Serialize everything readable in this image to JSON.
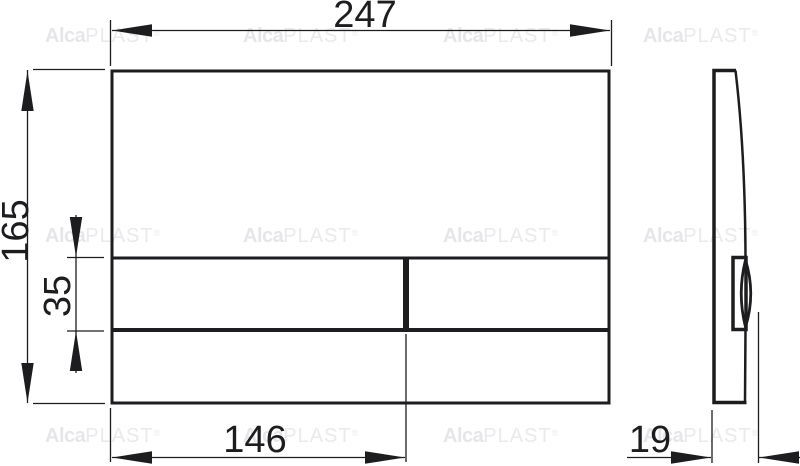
{
  "watermark": {
    "brand_bold": "Alca",
    "brand_rest": "PLAST",
    "registered": "®"
  },
  "drawing": {
    "front_view": {
      "width_mm": "247",
      "height_mm": "165",
      "button_row_height_mm": "35",
      "button_split_mm": "146"
    },
    "side_view": {
      "depth_mm": "19"
    }
  },
  "colors": {
    "line": "#1d1d20",
    "background": "#ffffff",
    "watermark": "#e6e6e9"
  }
}
